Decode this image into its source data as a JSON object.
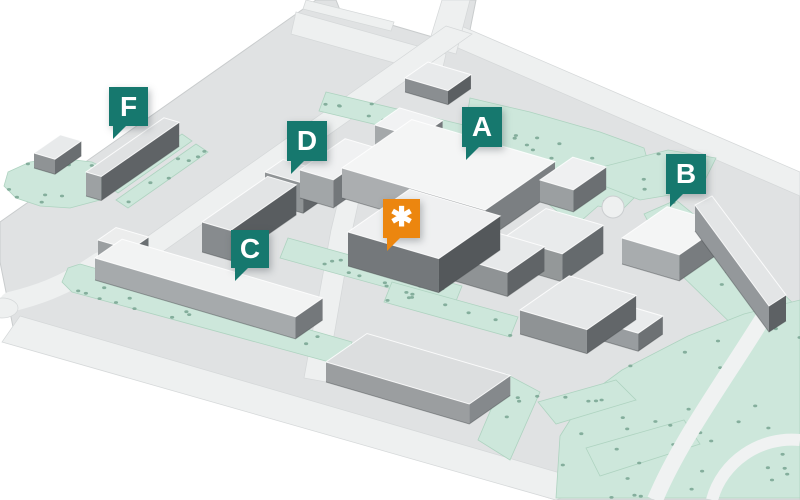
{
  "map": {
    "kind": "isometric-campus-map",
    "markers": [
      {
        "id": "f",
        "label": "F",
        "type": "location",
        "x": 109,
        "y": 87,
        "size": 39
      },
      {
        "id": "d",
        "label": "D",
        "type": "location",
        "x": 287,
        "y": 121,
        "size": 40
      },
      {
        "id": "a",
        "label": "A",
        "type": "location",
        "x": 462,
        "y": 107,
        "size": 40
      },
      {
        "id": "asterisk",
        "label": "✱",
        "type": "highlight",
        "x": 383,
        "y": 199,
        "size": 37
      },
      {
        "id": "c",
        "label": "C",
        "type": "location",
        "x": 231,
        "y": 230,
        "size": 38
      },
      {
        "id": "b",
        "label": "B",
        "type": "location",
        "x": 666,
        "y": 154,
        "size": 40
      }
    ],
    "colors": {
      "location_marker": "#16786e",
      "highlight_marker": "#ec860f",
      "marker_text": "#ffffff",
      "background": "#ffffff",
      "ground": "#e0e2e3",
      "road": "#eef0f0",
      "green_area": "#cde7db",
      "tree_dot": "#7da896",
      "building_top": "#f4f5f5",
      "building_side_light": "#a6aaac",
      "building_side_dark": "#6e7275"
    }
  }
}
